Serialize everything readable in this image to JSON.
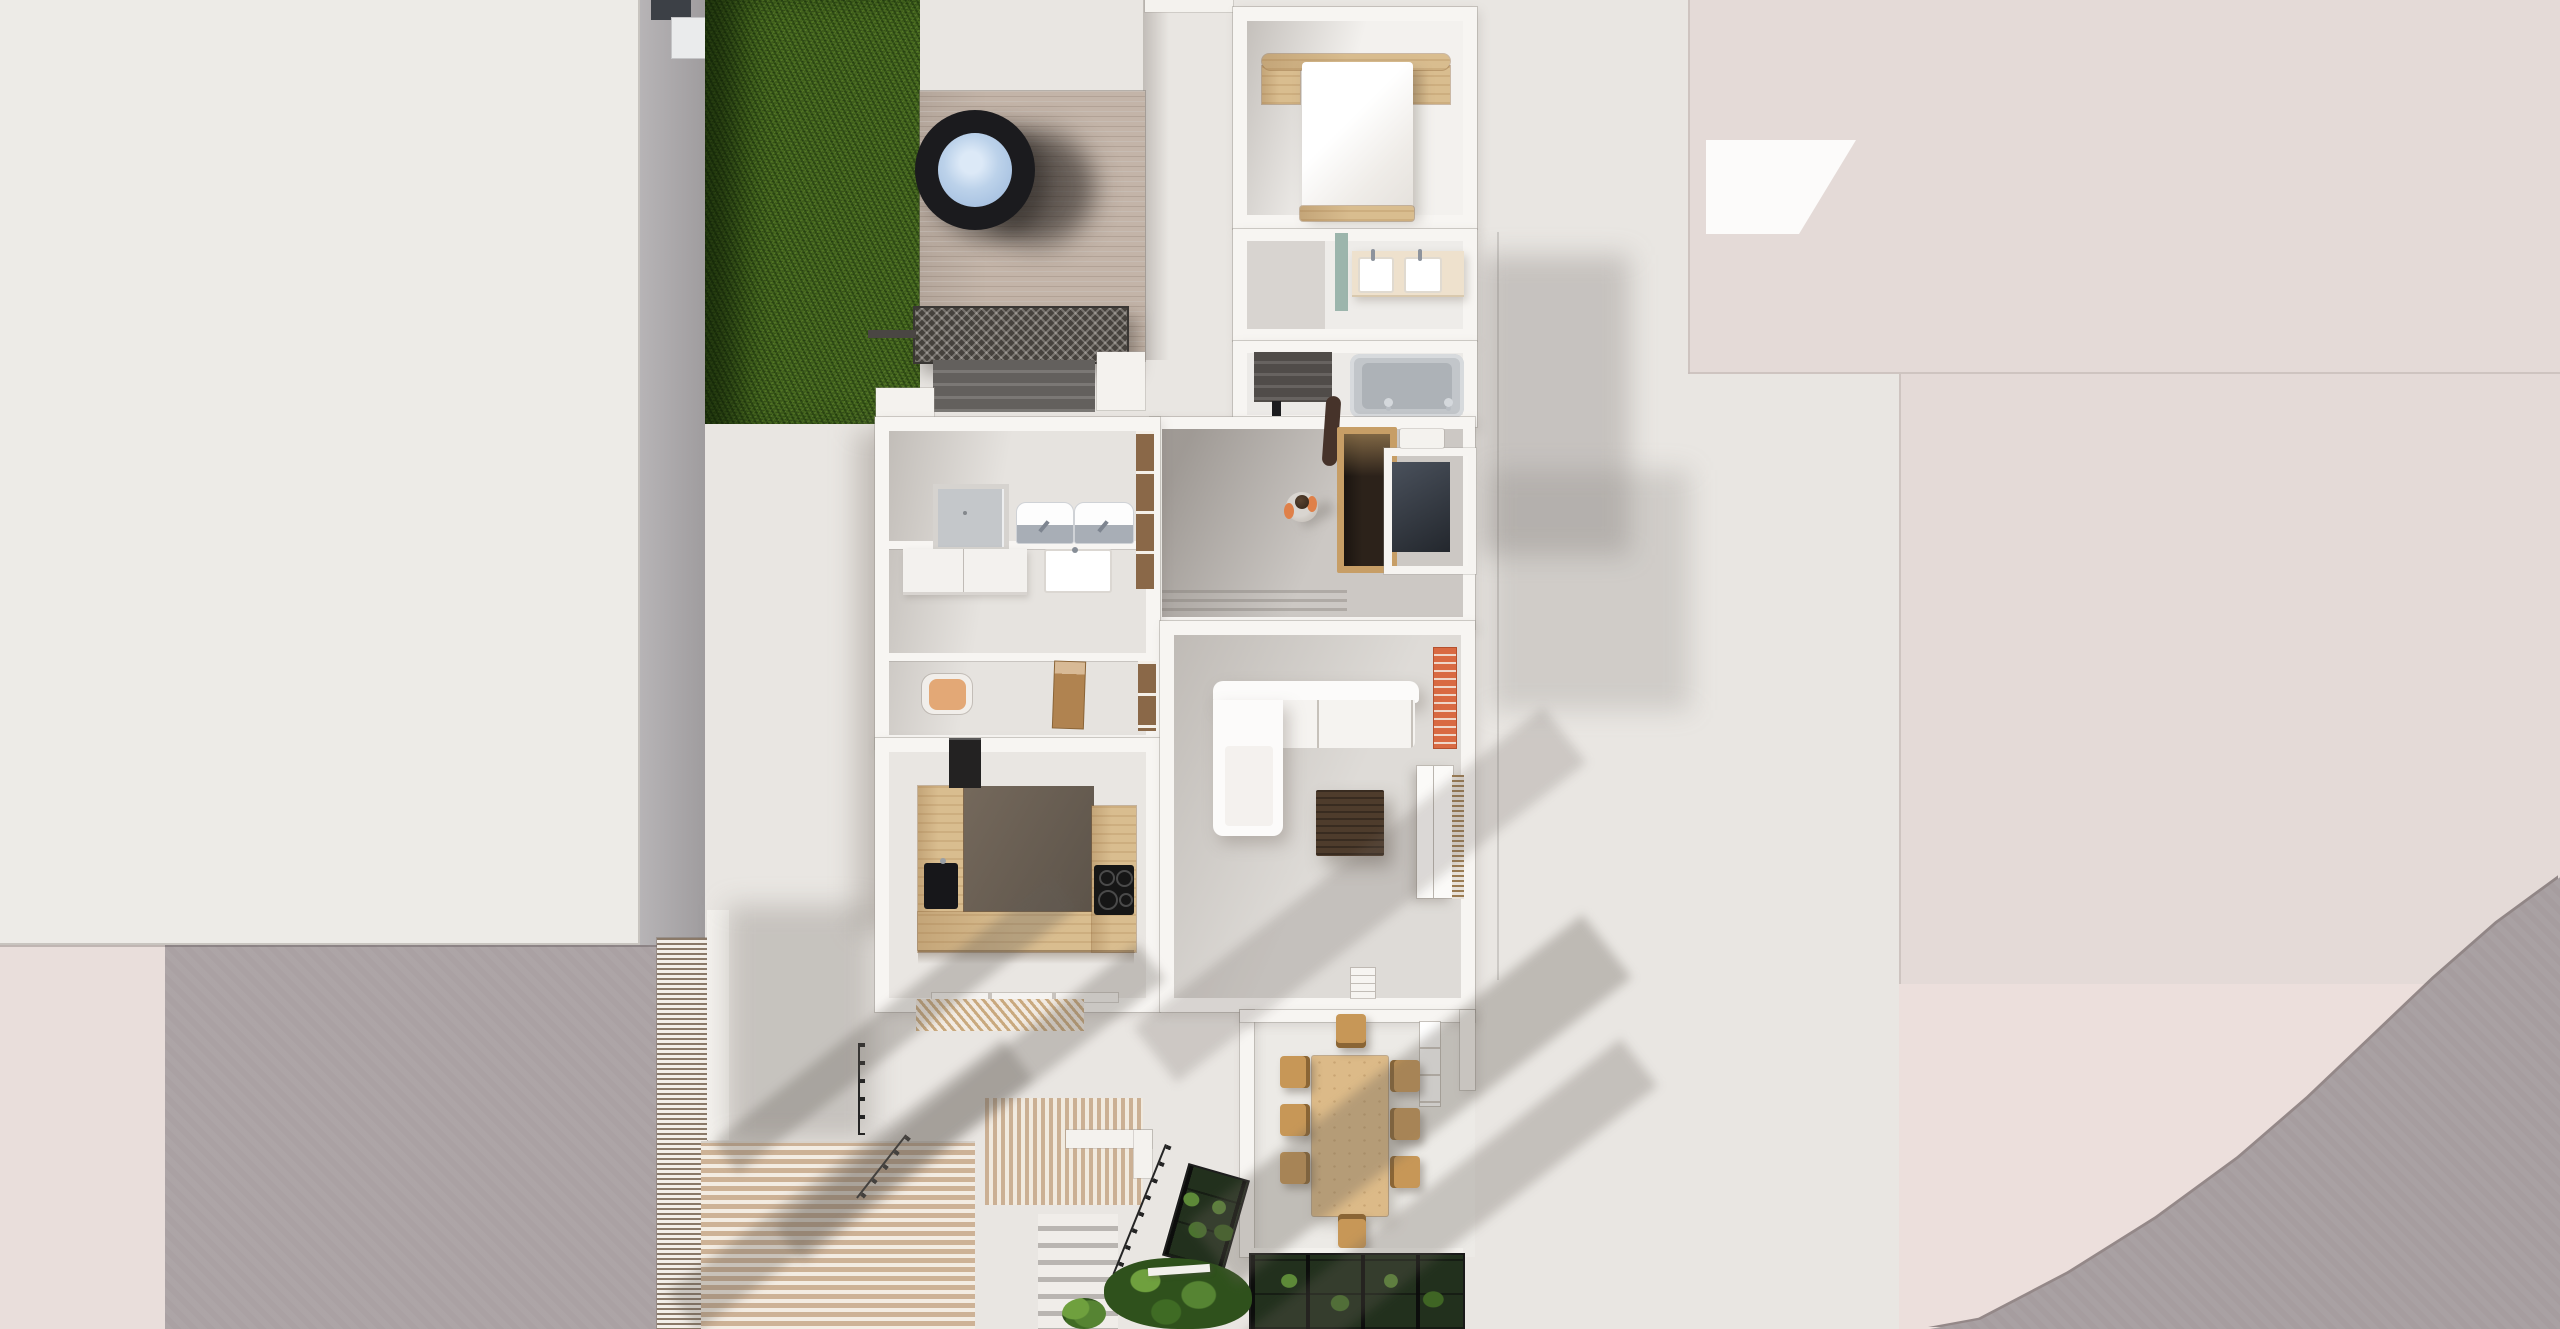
{
  "meta": {
    "title": "Top-down 3D architectural render — cutaway floor plan of a terraced house with roof deck, garden and neighbouring buildings",
    "type": "architectural-render",
    "visible_text": "none"
  },
  "palette": {
    "pavement": "#e9e6e2",
    "roof_left": "#edebe7",
    "roof_right": "#e4dad7",
    "pink_ground": "#ecdfdc",
    "road": "#a69d9f",
    "driveway": "#aaa1a3",
    "wall": "#f7f5f2",
    "floor_gray": "#ccc8c4",
    "grass": "#47691f",
    "deck_wood": "#c3b4a8",
    "oak": "#d9bd8f",
    "dining_oak": "#dcba88",
    "walnut": "#4e3c2c",
    "hot_tub_rim": "#1b1b1e",
    "water": "#bcd2ea",
    "brick": "#d96a42",
    "teal_tile": "#9cb5ac",
    "tan_chair": "#e3a876",
    "person_shirt": "#d9d5d0",
    "person_arm": "#df8049",
    "railing": "#242424"
  },
  "labels": {
    "scene": "Top-down 3D render of house floor plan",
    "neighbor_roof_left": "Neighbouring building roof (left)",
    "neighbor_roof_right": "Neighbouring building roof (right)",
    "pink_ground": "Neighbouring plot",
    "road": "Curved road",
    "driveway": "Paved driveway",
    "fence": "Timber slat screen",
    "lawn": "Lawn",
    "roof_deck": "Timber roof deck",
    "hot_tub": "Round hot tub",
    "pergola": "Pergola",
    "deck_stairs": "Deck stairs",
    "walkway": "Concrete walkway",
    "bedroom": "Bedroom",
    "bed": "Double bed",
    "nightstand": "Bedside table",
    "bathroom": "Bathroom",
    "vanity": "Double washbasin vanity",
    "teal_wall": "Tiled wall",
    "bathtub": "Bathtub",
    "interior_stairs": "Interior staircase",
    "shower": "Walk-in shower",
    "basin": "Washbasin unit",
    "utility": "Utility room",
    "utility_counter": "Utility counter",
    "utility_sink": "Utility sink",
    "study": "Study nook",
    "armchair": "Tan armchair",
    "desk_chair": "Wooden desk chair",
    "kitchen": "U-shaped kitchen",
    "kitchen_sink": "Kitchen sink",
    "hob": "Induction hob",
    "tall_unit": "Tall kitchen unit",
    "hallway": "Hallway landing",
    "stair_box": "Timber stairwell",
    "stair_panel": "Stair flight with railing",
    "person": "Person standing",
    "living_room": "Living room",
    "sofa": "White corner sofa",
    "coffee_table": "Walnut coffee table",
    "chimney": "Brick flue",
    "sideboard": "Sideboard",
    "slat_screen": "Slatted window seat",
    "dining_terrace": "Dining terrace",
    "dining_table": "Oak dining table",
    "dining_chair": "Dining chair",
    "conservatory": "Glass canopy with planting",
    "garden_steps": "Garden steps",
    "railing": "Metal railing",
    "shrub": "Shrub",
    "slat_deck": "Slatted timber terrace",
    "window": "Timber framed window"
  }
}
